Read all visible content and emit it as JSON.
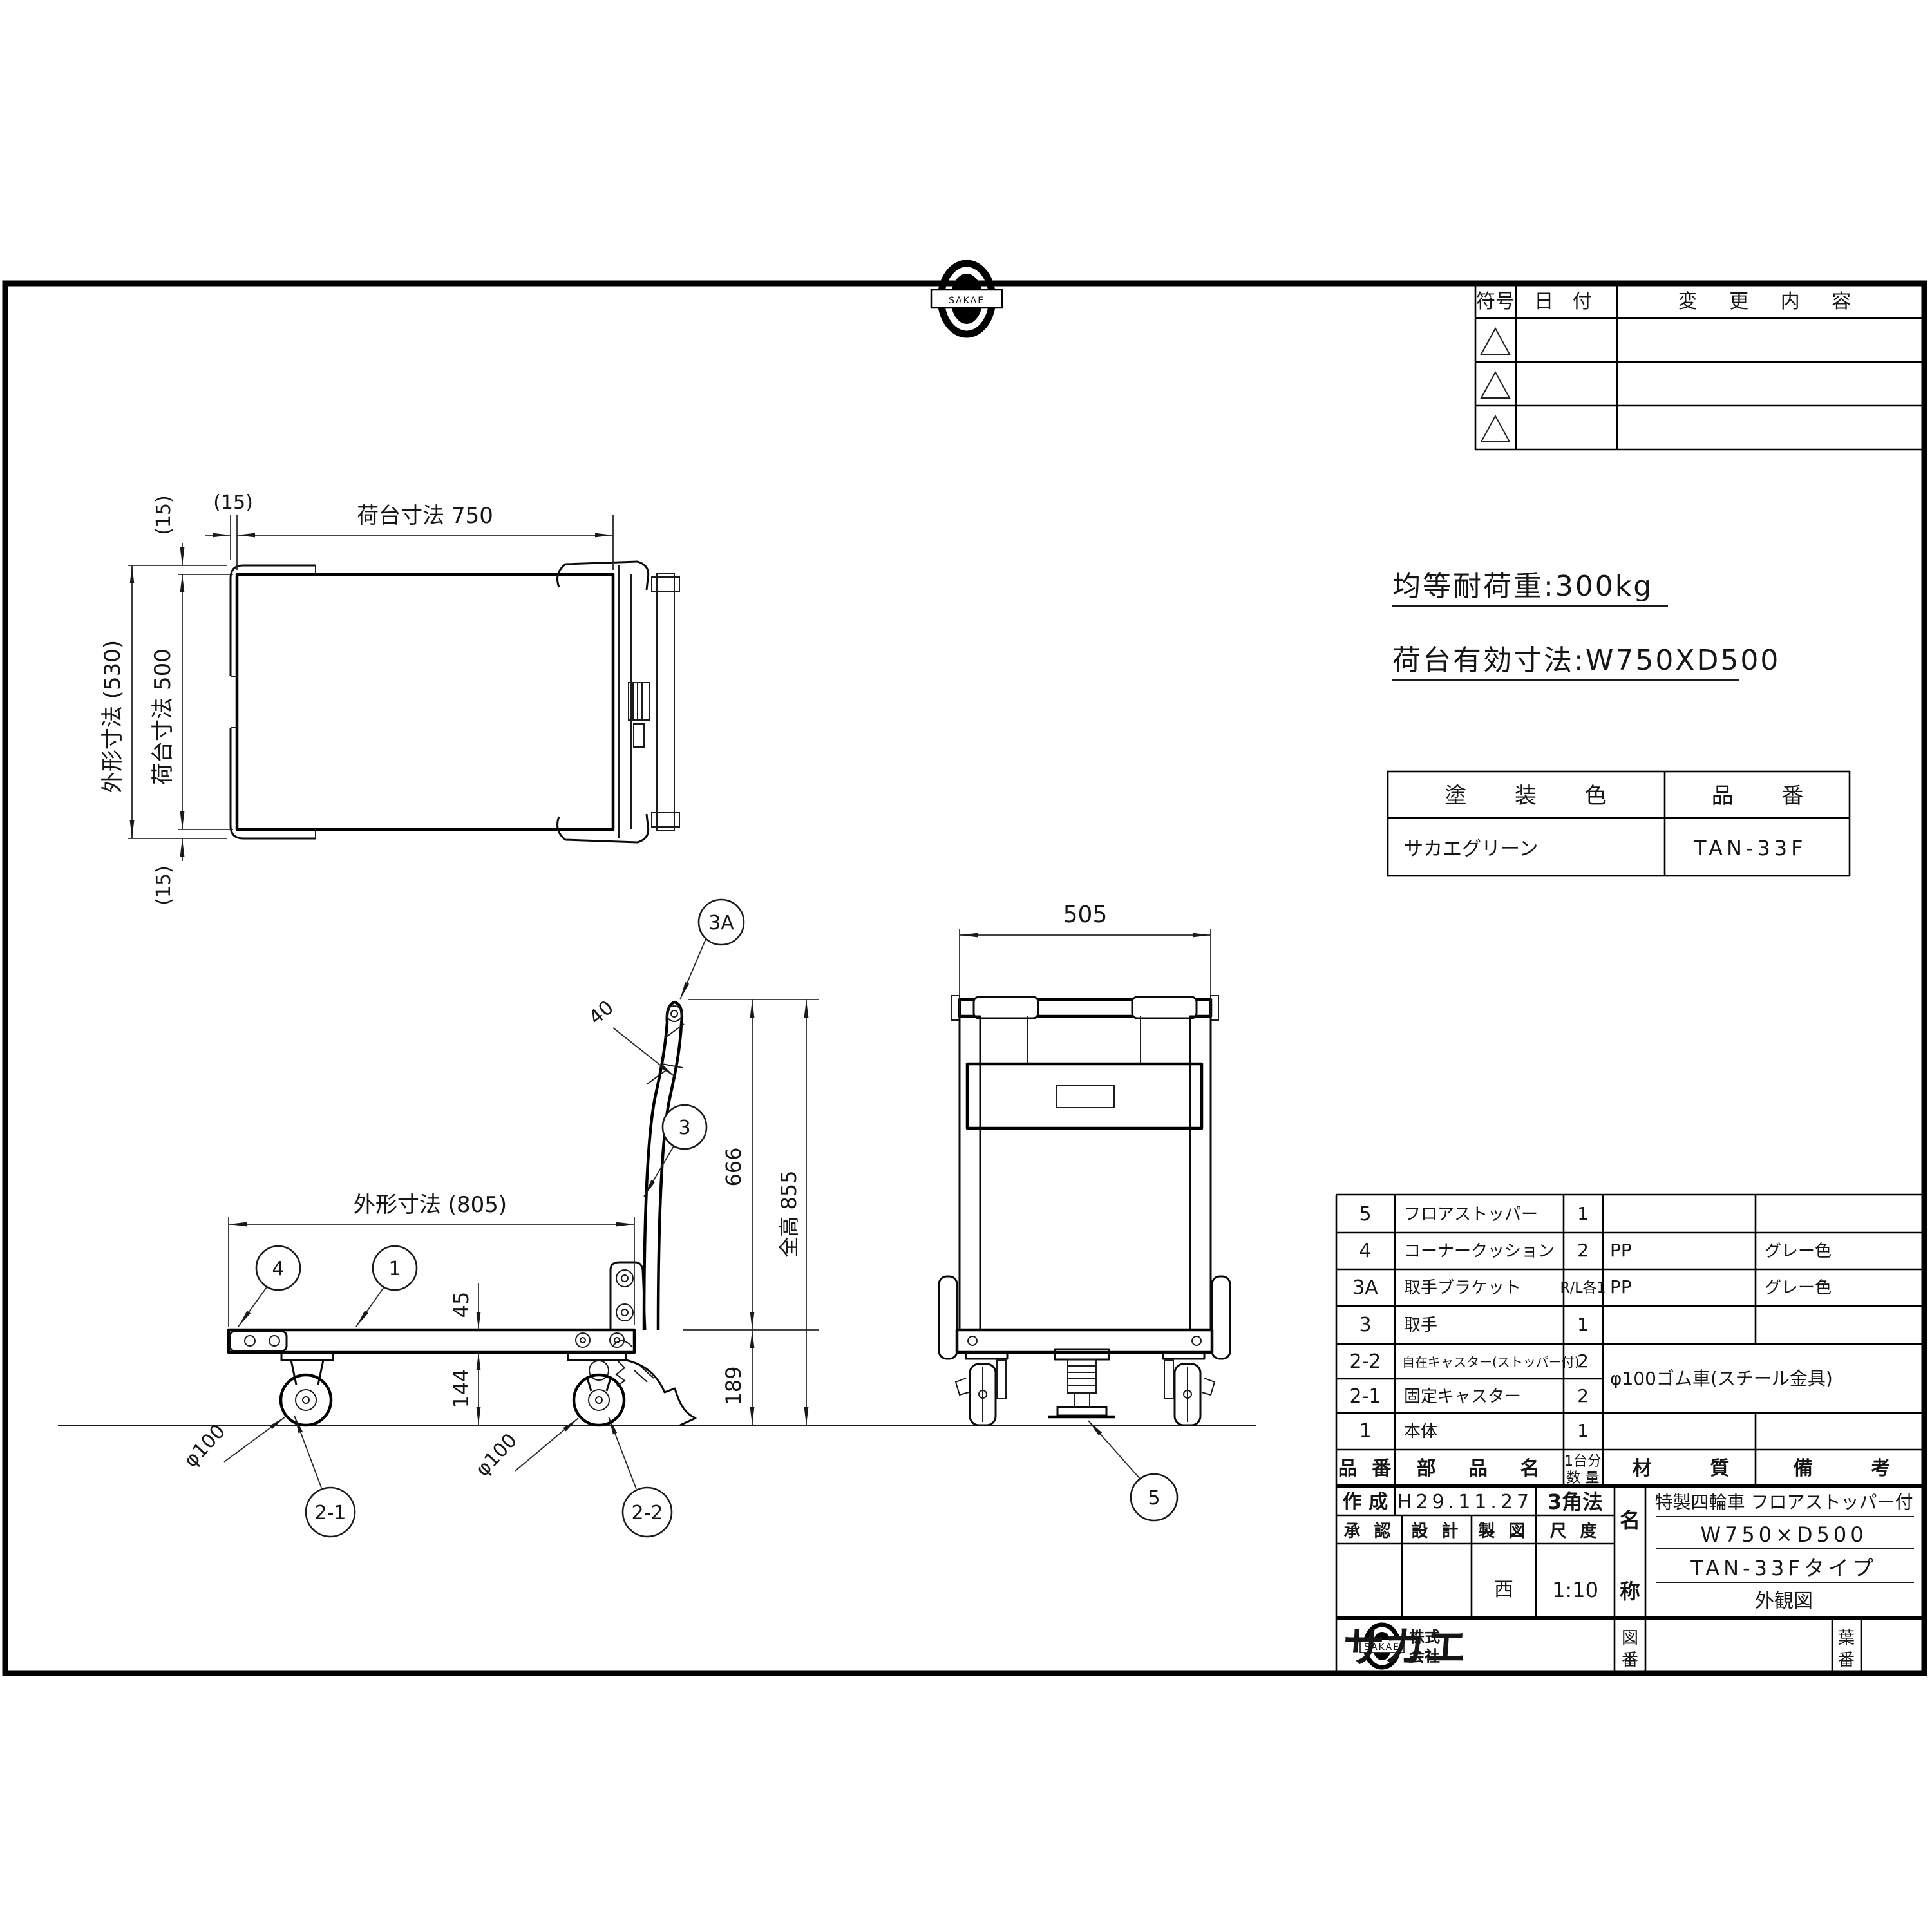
{
  "logo": {
    "brand": "SAKAE",
    "company_prefix_1": "株式",
    "company_prefix_2": "会社",
    "company_name": "サカエ"
  },
  "revision_table": {
    "col_symbol": "符号",
    "col_date": "日 付",
    "col_content": "変 更 内 容"
  },
  "specs": {
    "capacity": "均等耐荷重:300kg",
    "deck_size": "荷台有効寸法:W750XD500"
  },
  "paint_table": {
    "header_color": "塗 装 色",
    "header_part_no": "品 番",
    "color_value": "サカエグリーン",
    "part_no_value": "TAN-33F"
  },
  "top_view": {
    "dim_width": "荷台寸法 750",
    "dim_left_offset": "(15)",
    "dim_outer": "外形寸法 (530)",
    "dim_deck": "荷台寸法 500",
    "dim_top_offset": "(15)",
    "dim_bottom_offset": "(15)"
  },
  "side_view": {
    "dim_overall": "外形寸法 (805)",
    "dim_grip": "40",
    "dim_deck_thickness": "45",
    "dim_clearance": "144",
    "dim_deck_height": "189",
    "dim_handle_height": "666",
    "dim_total_height": "全高 855",
    "wheel_front": "φ100",
    "wheel_rear": "φ100",
    "balloon_3a": "3A",
    "balloon_3": "3",
    "balloon_4": "4",
    "balloon_1": "1",
    "balloon_2_1": "2-1",
    "balloon_2_2": "2-2"
  },
  "front_view": {
    "dim_width": "505",
    "balloon_5": "5"
  },
  "parts_table": {
    "headers": {
      "no": "品 番",
      "name": "部 品 名",
      "qty_line1": "1台分",
      "qty_line2": "数 量",
      "material": "材 質",
      "remarks": "備 考"
    },
    "rows": [
      {
        "no": "5",
        "name": "フロアストッパー",
        "qty": "1",
        "material": "",
        "remarks": ""
      },
      {
        "no": "4",
        "name": "コーナークッション",
        "qty": "2",
        "material": "PP",
        "remarks": "グレー色"
      },
      {
        "no": "3A",
        "name": "取手ブラケット",
        "qty": "R/L各1",
        "material": "PP",
        "remarks": "グレー色"
      },
      {
        "no": "3",
        "name": "取手",
        "qty": "1",
        "material": "",
        "remarks": ""
      },
      {
        "no": "2-2",
        "name": "自在キャスター(ストッパー付)",
        "qty": "2",
        "material": "",
        "remarks": ""
      },
      {
        "no": "2-1",
        "name": "固定キャスター",
        "qty": "2",
        "material": "",
        "remarks": ""
      },
      {
        "no": "1",
        "name": "本体",
        "qty": "1",
        "material": "",
        "remarks": ""
      }
    ],
    "merged_material": "φ100ゴム車(スチール金具)"
  },
  "title_block": {
    "created_label": "作 成",
    "created_date": "H29.11.27",
    "projection": "3角法",
    "approved_label": "承 認",
    "design_label": "設 計",
    "draft_label": "製 図",
    "scale_label": "尺 度",
    "draft_sign": "西",
    "scale_value": "1:10",
    "name_label_top": "名",
    "name_label_bottom": "称",
    "name_line_1": "特製四輪車 フロアストッパー付",
    "name_line_2": "W750×D500",
    "name_line_3": "TAN-33Fタイプ",
    "name_line_4": "外観図",
    "fig_label_top": "図",
    "fig_label_bottom": "番",
    "sheet_label_top": "葉",
    "sheet_label_bottom": "番"
  }
}
